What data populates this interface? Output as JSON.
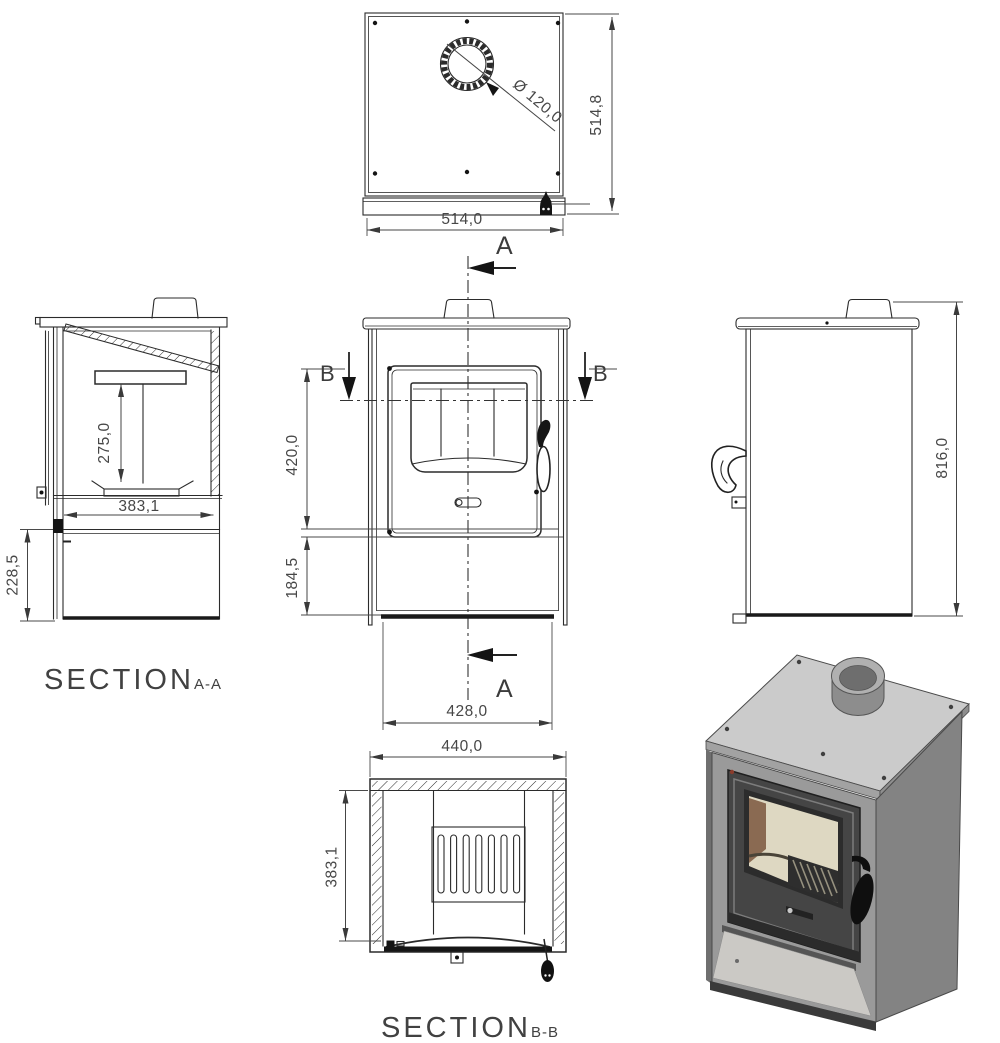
{
  "drawing": {
    "top_view": {
      "flue_diameter": "Ø 120,0",
      "outer_width": "514,0",
      "outer_depth": "514,8",
      "cut_label": "A"
    },
    "front_view": {
      "cut_label_a": "A",
      "cut_label_b": "B",
      "upper_height": "420,0",
      "base_height": "184,5",
      "body_width": "428,0"
    },
    "side_view": {
      "overall_height": "816,0"
    },
    "section_aa": {
      "title": "SECTION",
      "name": "A-A",
      "firebox_height": "275,0",
      "firebox_width": "383,1",
      "base_height": "228,5"
    },
    "section_bb": {
      "title": "SECTION",
      "name": "B-B",
      "outer_width": "440,0",
      "inner_depth": "383,1"
    },
    "colors": {
      "line": "#2b2b2b",
      "dimension_text": "#474747",
      "section_label": "#414141",
      "stove_top": "#cbcbcb",
      "stove_front": "#9a9a9a",
      "stove_side": "#838383",
      "door": "#454545",
      "glass_interior": "#ded8c2",
      "firebrick": "#8a6a52",
      "grate": "#2e2e2e",
      "handle": "#0f0f0f",
      "niche_floor": "#cbc9c5"
    }
  }
}
